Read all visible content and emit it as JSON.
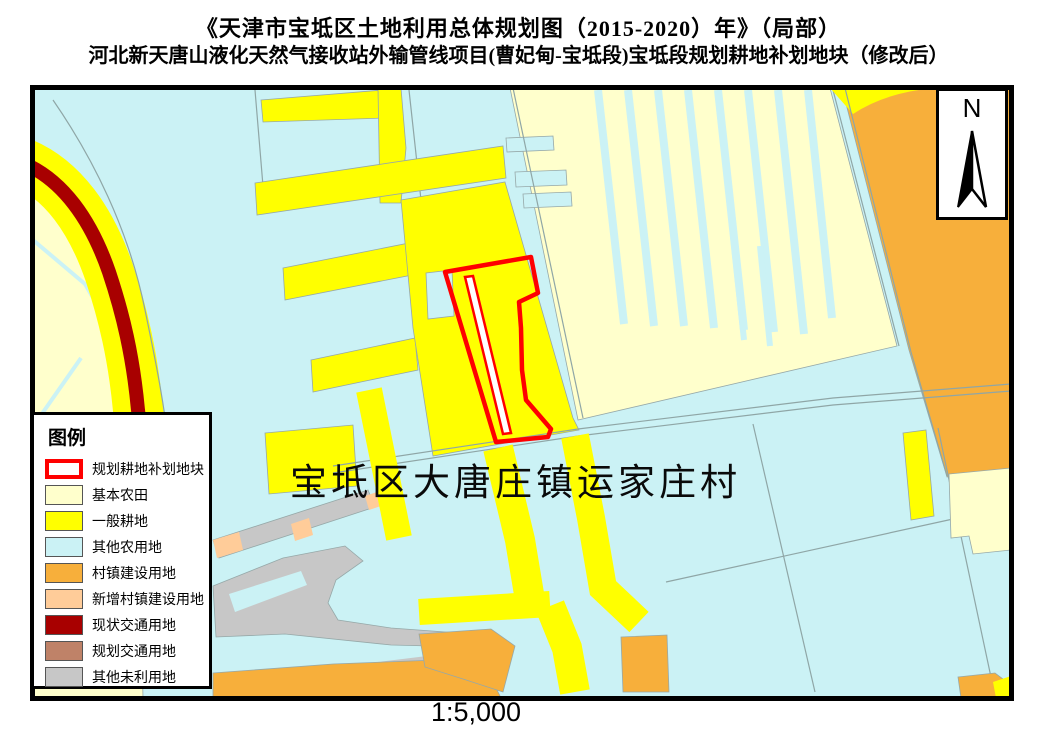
{
  "title": {
    "line1": "《天津市宝坻区土地利用总体规划图（2015-2020）年》（局部）",
    "line2": "河北新天唐山液化天然气接收站外输管线项目(曹妃甸-宝坻段)宝坻段规划耕地补划地块（修改后）"
  },
  "map": {
    "area_label": "宝坻区大唐庄镇运家庄村",
    "scale_text": "1:5,000",
    "north_label": "N"
  },
  "legend": {
    "title": "图例",
    "items": [
      {
        "label": "规划耕地补划地块",
        "fill": "#FFFFFF",
        "outline": "#FF0000"
      },
      {
        "label": "基本农田",
        "fill": "#FFFFCC"
      },
      {
        "label": "一般耕地",
        "fill": "#FFFF00"
      },
      {
        "label": "其他农用地",
        "fill": "#CBF2F5"
      },
      {
        "label": "村镇建设用地",
        "fill": "#F7AF3B"
      },
      {
        "label": "新增村镇建设用地",
        "fill": "#FFCC99"
      },
      {
        "label": "现状交通用地",
        "fill": "#A80000"
      },
      {
        "label": "规划交通用地",
        "fill": "#BF8268"
      },
      {
        "label": "其他未利用地",
        "fill": "#C7C7C7"
      }
    ]
  }
}
